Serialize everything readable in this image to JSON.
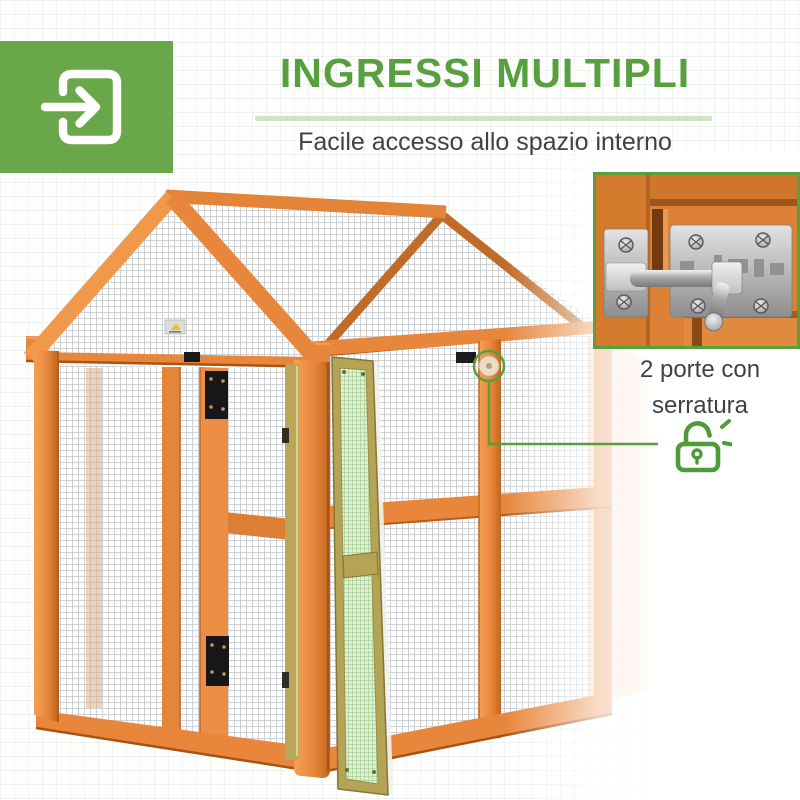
{
  "header": {
    "title": "INGRESSI MULTIPLI",
    "subtitle": "Facile accesso allo spazio interno",
    "colors": {
      "title_green": "#58A03F",
      "badge_green": "#69A74A",
      "divider_green": "#CFE4C4",
      "text_gray": "#3E4246"
    }
  },
  "badge": {
    "icon": "enter-arrow-icon"
  },
  "photo": {
    "depicts": "wooden chicken run with wire mesh walls, gable mesh roof and two open doors",
    "colors": {
      "wood_orange": "#E8873C",
      "door_frame_olive": "#B5A356",
      "door_mesh_green": "#DFF0D6"
    }
  },
  "detail_inset": {
    "depicts": "steel slide-bolt latch on orange wood door",
    "border_color": "#57A03C"
  },
  "callout": {
    "line1": "2 porte con",
    "line2": "serratura",
    "icon": "open-padlock-icon",
    "accent_color": "#55A03C"
  }
}
